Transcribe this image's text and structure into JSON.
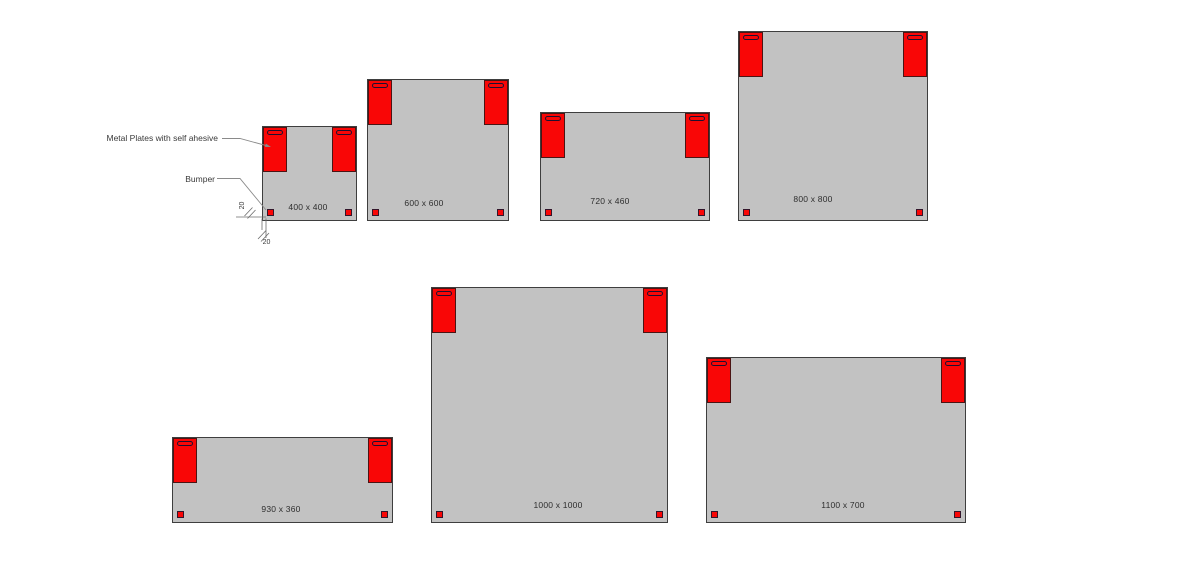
{
  "diagram": {
    "annotations": {
      "metal_plates": "Metal Plates with self ahesive",
      "bumper": "Bumper",
      "bumper_offset_vertical_mm": "20",
      "bumper_offset_horizontal_mm": "20"
    },
    "panels": [
      {
        "label": "400 x 400",
        "width_mm": 400,
        "height_mm": 400
      },
      {
        "label": "600 x 600",
        "width_mm": 600,
        "height_mm": 600
      },
      {
        "label": "720 x 460",
        "width_mm": 720,
        "height_mm": 460
      },
      {
        "label": "800 x 800",
        "width_mm": 800,
        "height_mm": 800
      },
      {
        "label": "930 x 360",
        "width_mm": 930,
        "height_mm": 360
      },
      {
        "label": "1000 x 1000",
        "width_mm": 1000,
        "height_mm": 1000
      },
      {
        "label": "1100 x 700",
        "width_mm": 1100,
        "height_mm": 700
      }
    ],
    "colors": {
      "background": "#ffffff",
      "panel_fill": "#c2c2c2",
      "panel_border": "#3e3e3e",
      "plate_red": "#f90606",
      "slot_outline": "#1d1030",
      "leader_line": "#8a8a8a"
    }
  }
}
